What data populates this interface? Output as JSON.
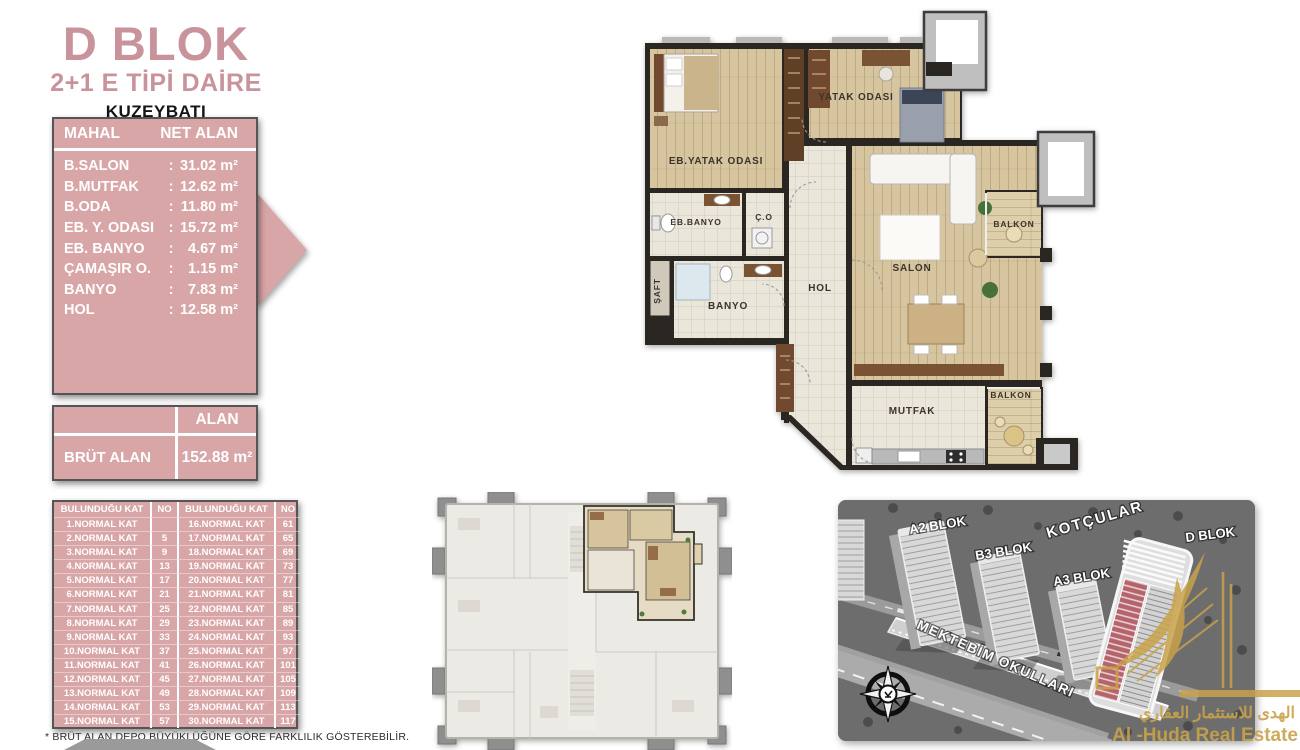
{
  "header": {
    "block_title": "D BLOK",
    "unit_type": "2+1 E TİPİ DAİRE",
    "orientation": "KUZEYBATI"
  },
  "net_area_table": {
    "col_mahal": "MAHAL",
    "col_net_alan": "NET ALAN",
    "rows": [
      {
        "label": "B.SALON",
        "sep": ":",
        "value": "31.02 m²"
      },
      {
        "label": "B.MUTFAK",
        "sep": ":",
        "value": "12.62 m²"
      },
      {
        "label": "B.ODA",
        "sep": ":",
        "value": "11.80 m²"
      },
      {
        "label": "EB. Y. ODASI",
        "sep": ":",
        "value": "15.72 m²"
      },
      {
        "label": "EB. BANYO",
        "sep": ":",
        "value": "4.67 m²"
      },
      {
        "label": "ÇAMAŞIR O.",
        "sep": ":",
        "value": "1.15 m²"
      },
      {
        "label": "BANYO",
        "sep": ":",
        "value": "7.83 m²"
      },
      {
        "label": "HOL",
        "sep": ":",
        "value": "12.58 m²"
      }
    ]
  },
  "gross_area_table": {
    "col_alan": "ALAN",
    "row_label": "BRÜT ALAN",
    "row_value": "152.88 m²"
  },
  "floor_table": {
    "col_kat": "BULUNDUĞU KAT",
    "col_no": "NO",
    "rows": [
      {
        "kat_l": "1.NORMAL KAT",
        "no_l": "",
        "kat_r": "16.NORMAL KAT",
        "no_r": "61"
      },
      {
        "kat_l": "2.NORMAL KAT",
        "no_l": "5",
        "kat_r": "17.NORMAL KAT",
        "no_r": "65"
      },
      {
        "kat_l": "3.NORMAL KAT",
        "no_l": "9",
        "kat_r": "18.NORMAL KAT",
        "no_r": "69"
      },
      {
        "kat_l": "4.NORMAL KAT",
        "no_l": "13",
        "kat_r": "19.NORMAL KAT",
        "no_r": "73"
      },
      {
        "kat_l": "5.NORMAL KAT",
        "no_l": "17",
        "kat_r": "20.NORMAL KAT",
        "no_r": "77"
      },
      {
        "kat_l": "6.NORMAL KAT",
        "no_l": "21",
        "kat_r": "21.NORMAL KAT",
        "no_r": "81"
      },
      {
        "kat_l": "7.NORMAL KAT",
        "no_l": "25",
        "kat_r": "22.NORMAL KAT",
        "no_r": "85"
      },
      {
        "kat_l": "8.NORMAL KAT",
        "no_l": "29",
        "kat_r": "23.NORMAL KAT",
        "no_r": "89"
      },
      {
        "kat_l": "9.NORMAL KAT",
        "no_l": "33",
        "kat_r": "24.NORMAL KAT",
        "no_r": "93"
      },
      {
        "kat_l": "10.NORMAL KAT",
        "no_l": "37",
        "kat_r": "25.NORMAL KAT",
        "no_r": "97"
      },
      {
        "kat_l": "11.NORMAL KAT",
        "no_l": "41",
        "kat_r": "26.NORMAL KAT",
        "no_r": "101"
      },
      {
        "kat_l": "12.NORMAL KAT",
        "no_l": "45",
        "kat_r": "27.NORMAL KAT",
        "no_r": "105"
      },
      {
        "kat_l": "13.NORMAL KAT",
        "no_l": "49",
        "kat_r": "28.NORMAL KAT",
        "no_r": "109"
      },
      {
        "kat_l": "14.NORMAL KAT",
        "no_l": "53",
        "kat_r": "29.NORMAL KAT",
        "no_r": "113"
      },
      {
        "kat_l": "15.NORMAL KAT",
        "no_l": "57",
        "kat_r": "30.NORMAL KAT",
        "no_r": "117"
      }
    ]
  },
  "footnote": "* BRÜT ALAN DEPO BÜYÜKLÜĞÜNE GÖRE FARKLILIK GÖSTEREBİLİR.",
  "floor_plan": {
    "labels": {
      "yatak_odasi": "YATAK ODASI",
      "eb_yatak_odasi": "EB.YATAK ODASI",
      "eb_banyo": "EB.BANYO",
      "co": "Ç.O",
      "saft": "ŞAFT",
      "banyo": "BANYO",
      "hol": "HOL",
      "salon": "SALON",
      "balkon_ust": "BALKON",
      "mutfak": "MUTFAK",
      "balkon_alt": "BALKON"
    }
  },
  "site_map": {
    "labels": {
      "a2": "A2 BLOK",
      "b3": "B3 BLOK",
      "a3": "A3 BLOK",
      "kotcular": "KOTÇULAR",
      "d": "D BLOK",
      "mektebim": "MEKTEBİM OKULLARI"
    },
    "watermark": {
      "arabic": "الهدى للاستثمار العقاري",
      "latin": "Al -Huda Real Estate"
    }
  },
  "colors": {
    "accent_pink": "#d9a6a8",
    "title_pink": "#c8939b",
    "highlight_red": "#b5646c",
    "watermark_gold": "#c9a34a"
  }
}
